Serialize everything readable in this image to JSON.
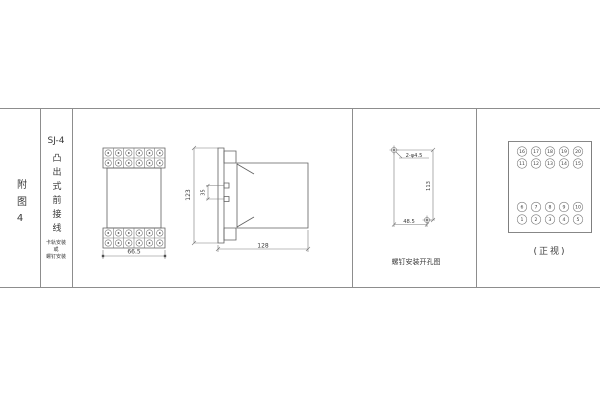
{
  "figure": {
    "row_label": "附图4"
  },
  "title_block": {
    "model": "SJ-4",
    "connection_type": "凸出式前接线",
    "mount_lines": [
      "卡轨安装",
      "或",
      "螺钉安装"
    ]
  },
  "front_view": {
    "width_dim": "66.5"
  },
  "side_view": {
    "height_dim": "123",
    "notch_dim": "35",
    "depth_dim": "128"
  },
  "drill_view": {
    "holes_label": "2-φ4.5",
    "vertical_dim": "113",
    "horizontal_dim": "48.5",
    "caption": "螺钉安装开孔图"
  },
  "terminal_view": {
    "rows": [
      [
        "16",
        "17",
        "18",
        "19",
        "20"
      ],
      [
        "11",
        "12",
        "13",
        "14",
        "15"
      ],
      [
        "6",
        "7",
        "8",
        "9",
        "10"
      ],
      [
        "1",
        "2",
        "3",
        "4",
        "5"
      ]
    ],
    "caption": "(正视)"
  }
}
